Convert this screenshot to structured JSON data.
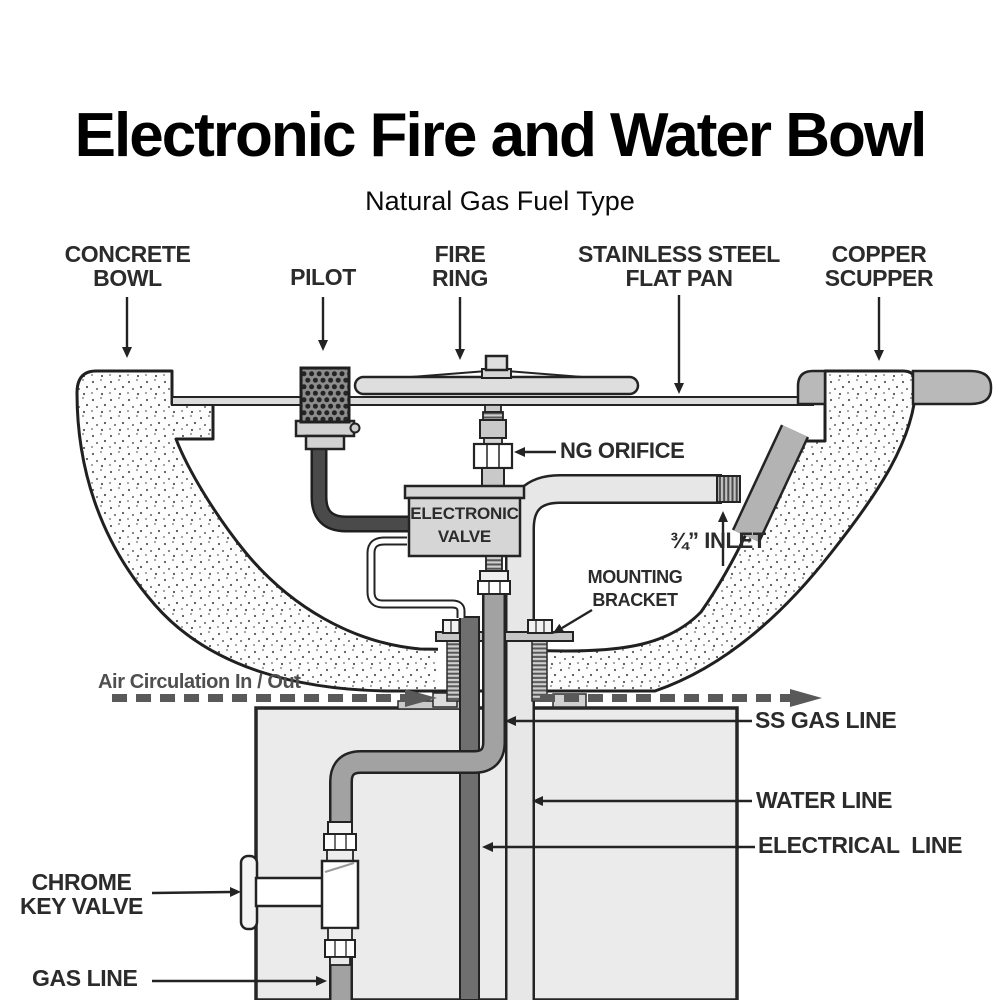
{
  "title": "Electronic Fire and Water Bowl",
  "subtitle": "Natural Gas Fuel Type",
  "callouts": {
    "concrete_bowl": {
      "line1": "CONCRETE",
      "line2": "BOWL"
    },
    "pilot": {
      "line1": "PILOT"
    },
    "fire_ring": {
      "line1": "FIRE",
      "line2": "RING"
    },
    "flat_pan": {
      "line1": "STAINLESS STEEL",
      "line2": "FLAT PAN"
    },
    "copper_scupper": {
      "line1": "COPPER",
      "line2": "SCUPPER"
    },
    "ng_orifice": "NG ORIFICE",
    "inlet": "¾” INLET",
    "mounting_bracket": {
      "line1": "MOUNTING",
      "line2": "BRACKET"
    },
    "air_circulation": "Air Circulation In / Out",
    "ss_gas_line": "SS GAS LINE",
    "water_line": "WATER LINE",
    "electrical_line": "ELECTRICAL  LINE",
    "chrome_key_valve": {
      "line1": "CHROME",
      "line2": "KEY VALVE"
    },
    "gas_line": "GAS LINE"
  },
  "components": {
    "electronic_valve": {
      "line1": "ELECTRONIC",
      "line2": "VALVE"
    }
  },
  "colors": {
    "ink": "#232323",
    "label": "#2b2b2b",
    "gray-note": "#4f4f4f",
    "metal-light": "#dedede",
    "metal-mid": "#b9b9b9",
    "gas-tube": "#a2a2a2",
    "conduit": "#6f6f6f",
    "pilot-tube": "#4a4a4a",
    "pedestal": "#ebebeb",
    "valve-fill": "#d6d6d6"
  }
}
